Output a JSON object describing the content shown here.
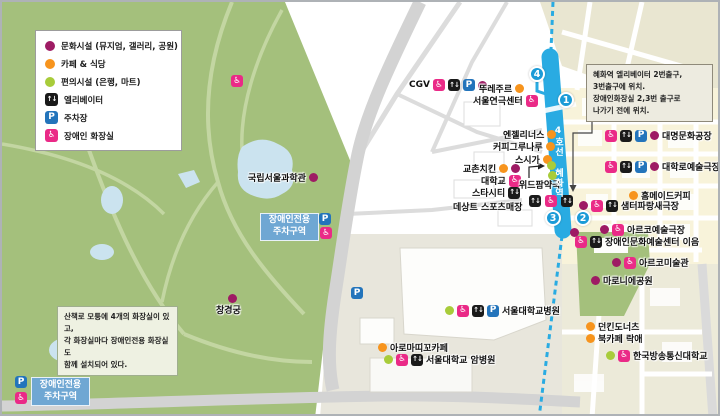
{
  "legend": {
    "items": [
      {
        "marker": "dot-culture",
        "label": "문화시설 (뮤지엄, 갤러리, 공원)"
      },
      {
        "marker": "dot-cafe",
        "label": "카페 & 식당"
      },
      {
        "marker": "dot-convenience",
        "label": "편의시설 (은행, 마트)"
      },
      {
        "marker": "icon-elevator",
        "label": "엘리베이터"
      },
      {
        "marker": "icon-parking",
        "label": "주차장"
      },
      {
        "marker": "icon-accessible",
        "label": "장애인 화장실"
      }
    ]
  },
  "station": {
    "line_name_vertical": "4호선 혜화역",
    "exits": [
      "1",
      "2",
      "3",
      "4"
    ]
  },
  "info_boxes": {
    "station_elevator": {
      "lines": [
        "혜화역 엘리베이터 2번출구,",
        "3번출구에 위치.",
        "장애인화장실 2,3번 출구로",
        "나가기 전에 위치."
      ]
    },
    "park_toilets": {
      "lines": [
        "산책로 모퉁에 4개의 화장실이 있고,",
        "각 화장실마다 장애인전용 화장실도",
        "함께 설치되어 있다."
      ]
    }
  },
  "labels": {
    "reserved_parking": {
      "line1": "장애인전용",
      "line2": "주차구역"
    }
  },
  "icon_glyphs": {
    "elevator": "↑↓",
    "parking": "P",
    "wheelchair": "♿"
  },
  "colors": {
    "culture_dot": "#9e1b64",
    "cafe_dot": "#f7941d",
    "convenience_dot": "#a8cc3a",
    "elevator_icon_bg": "#1a1a1a",
    "parking_icon_bg": "#2374bb",
    "accessible_icon_bg": "#ea2a87",
    "subway_line": "#29abe2",
    "park_green": "#a4c07c",
    "reserved_parking_label_bg": "#6fa7d3"
  },
  "pois": [
    {
      "id": "cgv",
      "label": "CGV",
      "x": 407,
      "y": 77,
      "side": "right",
      "markers": [
        "icon-accessible",
        "icon-elevator",
        "icon-parking",
        "dot-culture"
      ]
    },
    {
      "id": "tous-les-jours",
      "label": "뚜레주르",
      "x": 477,
      "y": 80,
      "side": "right",
      "markers": [
        "dot-cafe"
      ]
    },
    {
      "id": "seoul-theater-center",
      "label": "서울연극센터",
      "x": 471,
      "y": 92,
      "side": "right",
      "markers": [
        "icon-accessible"
      ]
    },
    {
      "id": "angelinus",
      "label": "엔젤리너스",
      "x": 501,
      "y": 126,
      "side": "right",
      "markers": [
        "dot-cafe"
      ]
    },
    {
      "id": "coffee-gurunaru",
      "label": "커피그루나루",
      "x": 491,
      "y": 138,
      "side": "right",
      "markers": [
        "dot-cafe"
      ]
    },
    {
      "id": "sushiga",
      "label": "스시가",
      "x": 513,
      "y": 151,
      "side": "right",
      "markers": [
        "dot-cafe"
      ]
    },
    {
      "id": "kyochon-chicken",
      "label": "교촌치킨",
      "x": 461,
      "y": 160,
      "side": "right",
      "markers": [
        "dot-cafe",
        "dot-culture"
      ]
    },
    {
      "id": "university",
      "label": "대학교",
      "x": 479,
      "y": 172,
      "side": "right",
      "markers": [
        "icon-accessible"
      ]
    },
    {
      "id": "starcity",
      "label": "스타시티",
      "x": 470,
      "y": 184,
      "side": "right",
      "markers": [
        "icon-elevator"
      ]
    },
    {
      "id": "withpharm-pharmacy",
      "label": "위드팜약국",
      "x": 517,
      "y": 176,
      "side": "right",
      "markers": []
    },
    {
      "id": "descente-sports",
      "label": "데상트 스포츠매장",
      "x": 451,
      "y": 198,
      "side": "right",
      "markers": []
    },
    {
      "id": "national-science-museum",
      "label": "국립서울과학관",
      "x": 246,
      "y": 169,
      "side": "right",
      "markers": [
        "dot-culture"
      ]
    },
    {
      "id": "changgyeonggung",
      "label": "창경궁",
      "x": 214,
      "y": 301,
      "side": "right",
      "markers": []
    },
    {
      "id": "snu-hospital",
      "label": "서울대학교병원",
      "x": 443,
      "y": 302,
      "side": "left",
      "markers": [
        "dot-convenience",
        "icon-accessible",
        "icon-elevator",
        "icon-parking"
      ]
    },
    {
      "id": "aromatico-cafe",
      "label": "아로마띠꼬카페",
      "x": 376,
      "y": 339,
      "side": "left",
      "markers": [
        "dot-cafe"
      ]
    },
    {
      "id": "snu-cancer-hospital",
      "label": "서울대학교 암병원",
      "x": 382,
      "y": 351,
      "side": "left",
      "markers": [
        "dot-convenience",
        "icon-accessible",
        "icon-elevator"
      ]
    },
    {
      "id": "daemyung-culture-factory",
      "label": "대명문화공장",
      "x": 603,
      "y": 127,
      "side": "left",
      "markers": [
        "icon-accessible",
        "icon-elevator",
        "icon-parking",
        "dot-culture"
      ]
    },
    {
      "id": "daehakro-arts-theater",
      "label": "대학로예술극장",
      "x": 603,
      "y": 158,
      "side": "left",
      "markers": [
        "icon-accessible",
        "icon-elevator",
        "icon-parking",
        "dot-culture"
      ]
    },
    {
      "id": "homemade-coffee",
      "label": "홈메이드커피",
      "x": 627,
      "y": 187,
      "side": "left",
      "markers": [
        "dot-cafe"
      ]
    },
    {
      "id": "saemteo-parangsae-theater",
      "label": "샘터파랑새극장",
      "x": 577,
      "y": 197,
      "side": "left",
      "markers": [
        "dot-culture",
        "icon-accessible",
        "icon-elevator"
      ]
    },
    {
      "id": "arko-arts-theater",
      "label": "아르코예술극장",
      "x": 598,
      "y": 221,
      "side": "left",
      "markers": [
        "dot-culture",
        "icon-accessible"
      ]
    },
    {
      "id": "ieum-center",
      "label": "장애인문화예술센터 이음",
      "x": 573,
      "y": 233,
      "side": "left",
      "markers": [
        "icon-accessible",
        "icon-elevator"
      ]
    },
    {
      "id": "arko-art-museum",
      "label": "아르코미술관",
      "x": 610,
      "y": 254,
      "side": "left",
      "markers": [
        "dot-culture",
        "icon-accessible"
      ]
    },
    {
      "id": "maronnier-park",
      "label": "마로니에공원",
      "x": 589,
      "y": 272,
      "side": "left",
      "markers": [
        "dot-culture"
      ]
    },
    {
      "id": "dunkin-donuts",
      "label": "던킨도너츠",
      "x": 584,
      "y": 318,
      "side": "left",
      "markers": [
        "dot-cafe"
      ]
    },
    {
      "id": "book-cafe-rakae",
      "label": "북카페 락애",
      "x": 584,
      "y": 330,
      "side": "left",
      "markers": [
        "dot-cafe"
      ]
    },
    {
      "id": "knou-university",
      "label": "한국방송통신대학교",
      "x": 604,
      "y": 347,
      "side": "left",
      "markers": [
        "dot-convenience",
        "icon-accessible"
      ]
    }
  ],
  "standalone_markers": [
    {
      "type": "icon-accessible",
      "x": 229,
      "y": 73
    },
    {
      "type": "icon-accessible",
      "x": 162,
      "y": 351
    },
    {
      "type": "icon-parking",
      "x": 349,
      "y": 285
    },
    {
      "type": "dot-convenience",
      "x": 545,
      "y": 159
    },
    {
      "type": "dot-convenience",
      "x": 546,
      "y": 169
    },
    {
      "type": "dot-culture",
      "x": 568,
      "y": 226
    },
    {
      "type": "icon-elevator",
      "x": 527,
      "y": 193
    },
    {
      "type": "icon-accessible",
      "x": 543,
      "y": 193
    },
    {
      "type": "icon-elevator",
      "x": 559,
      "y": 193
    },
    {
      "type": "dot-culture",
      "x": 226,
      "y": 292
    }
  ]
}
